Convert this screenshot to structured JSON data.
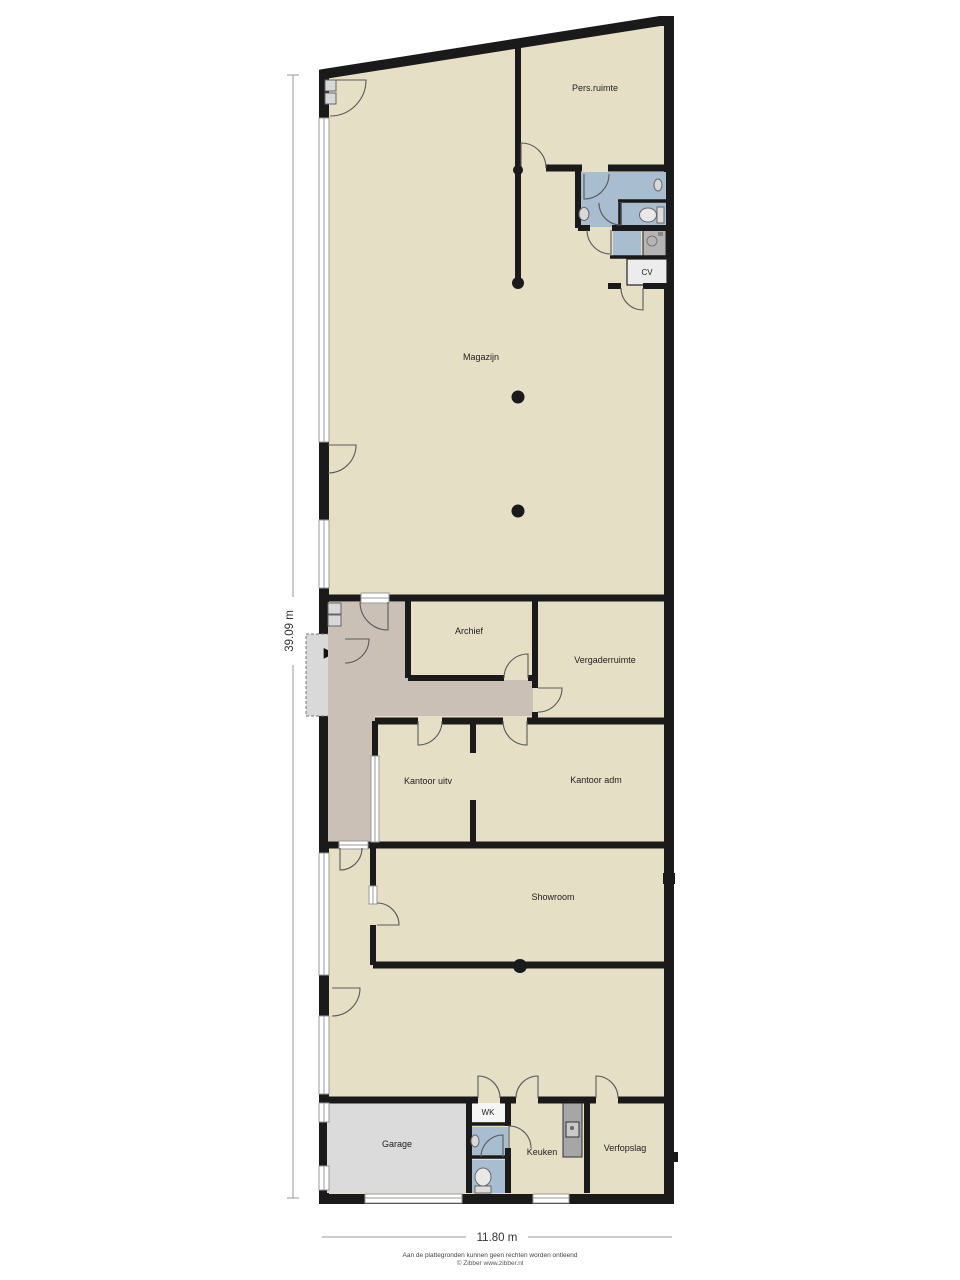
{
  "rooms": {
    "pers_ruimte": "Pers.ruimte",
    "magazijn": "Magazijn",
    "cv": "CV",
    "archief": "Archief",
    "vergaderruimte": "Vergaderruimte",
    "kantoor_uitv": "Kantoor uitv",
    "kantoor_adm": "Kantoor adm",
    "showroom": "Showroom",
    "garage": "Garage",
    "wk": "WK",
    "keuken": "Keuken",
    "verfopslag": "Verfopslag"
  },
  "dimensions": {
    "height_label": "39.09 m",
    "width_label": "11.80 m"
  },
  "footer": {
    "disclaimer": "Aan de plattegronden kunnen geen rechten worden ontleend",
    "credit": "© Zibber www.zibber.nl"
  },
  "symbols": {
    "lift_arrow": "▶"
  },
  "colors": {
    "floor": "#E5DFC6",
    "hallway": "#CBC0B5",
    "wet_room": "#A9BDD1",
    "garage_floor": "#DBDBDB",
    "wk_room": "#F5F5F5",
    "cv_room": "#ECECEC",
    "appliance": "#B5B5B5",
    "counter": "#A6A6A6",
    "platform": "#D9D9D9",
    "wall": "#1A1A1A"
  }
}
